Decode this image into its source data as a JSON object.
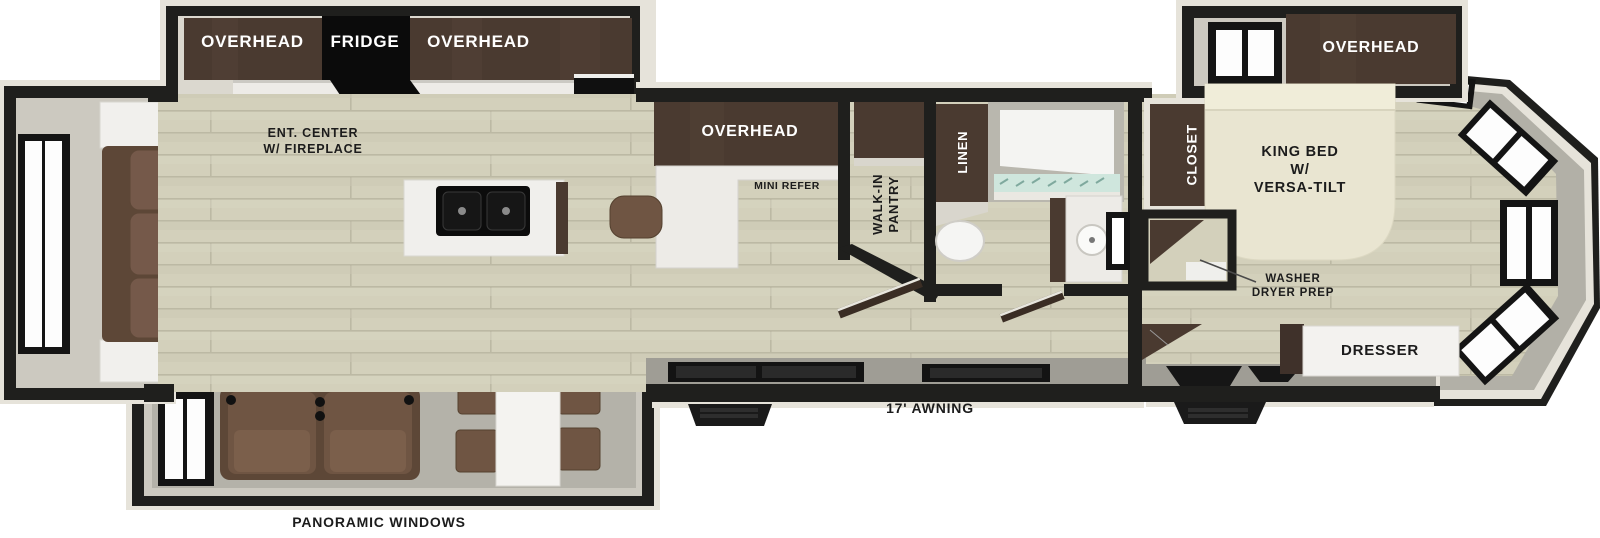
{
  "title": "RV fifth-wheel floor plan",
  "labels": {
    "kitchen_slide": {
      "overhead_left": "OVERHEAD",
      "fridge": "FRIDGE",
      "overhead_right": "OVERHEAD",
      "ent_center": "ENT. CENTER\nW/ FIREPLACE"
    },
    "kitchen": {
      "overhead": "OVERHEAD",
      "mini_refer": "MINI REFER"
    },
    "pantry": "WALK-IN\nPANTRY",
    "bathroom": {
      "linen": "LINEN"
    },
    "bedroom": {
      "overhead": "OVERHEAD",
      "closet": "CLOSET",
      "king_bed": "KING BED\nW/\nVERSA-TILT",
      "washer": "WASHER\nDRYER PREP",
      "dresser": "DRESSER"
    },
    "exterior": {
      "awning": "17' AWNING",
      "panoramic": "PANORAMIC WINDOWS"
    }
  },
  "colors": {
    "wall": "#1f1f1d",
    "trim": "#e6e3da",
    "floor": "#d3d0bb",
    "floor_line": "#bcb9a4",
    "slide_floor": "#b4b2a9",
    "slide_wall": "#ccc9c0",
    "cabinet": "#4a3a30",
    "appliance": "#0b0b0b",
    "counter": "#edebe7",
    "sofa": "#6f5543",
    "bed": "#e9e5d1",
    "fireplace_glow": "#e08a1e",
    "shower_glass": "#cfe6dd",
    "wall_face": "#9f9d95"
  }
}
